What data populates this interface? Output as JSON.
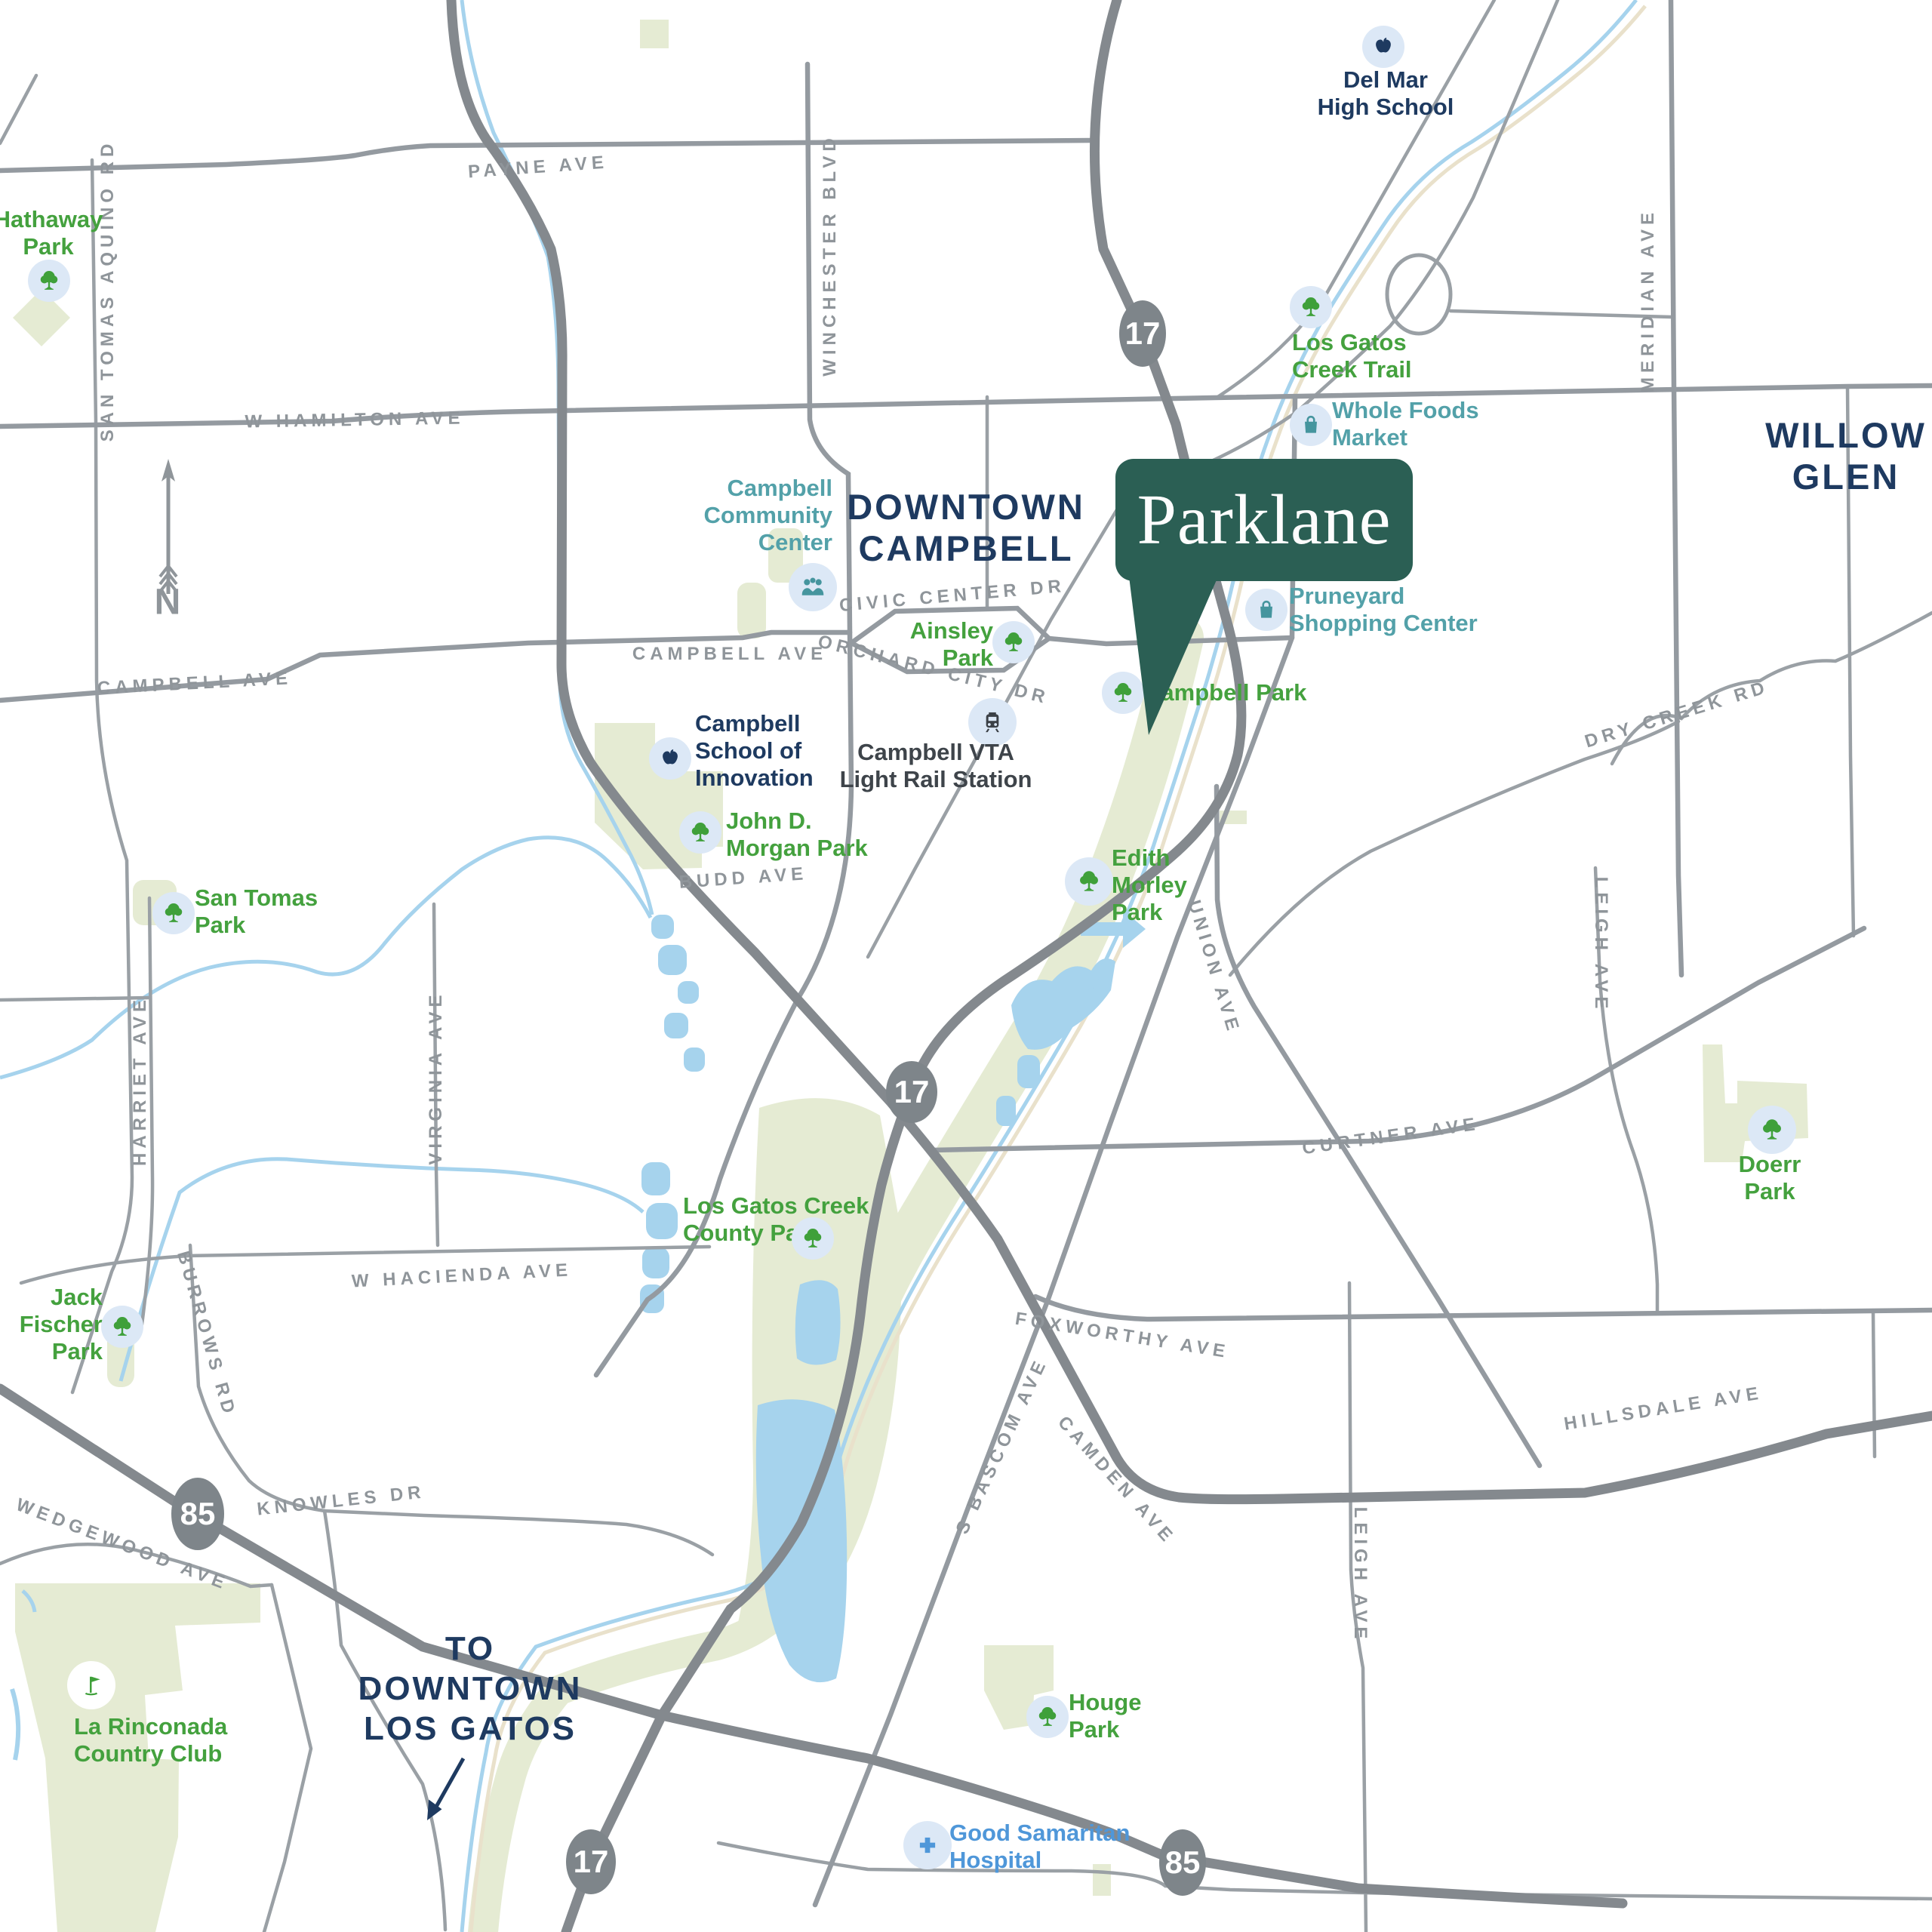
{
  "brand": {
    "name": "Parklane"
  },
  "compass": {
    "label": "N"
  },
  "areas": {
    "downtown_campbell": "DOWNTOWN\nCAMPBELL",
    "willow_glen": "WILLOW\nGLEN",
    "to_downtown_los_gatos": "TO\nDOWNTOWN\nLOS GATOS"
  },
  "shields": {
    "hwy_17": "17",
    "hwy_85": "85"
  },
  "roads": {
    "payne": "PAYNE AVE",
    "san_tomas_aquino": "SAN TOMAS AQUINO RD",
    "w_hamilton": "W HAMILTON AVE",
    "winchester": "WINCHESTER BLVD",
    "campbell_w": "CAMPBELL AVE",
    "campbell_e": "CAMPBELL AVE",
    "civic_center": "CIVIC CENTER DR",
    "orchard_city": "ORCHARD CITY DR",
    "budd": "BUDD AVE",
    "harriet": "HARRIET AVE",
    "virginia": "VIRGINIA AVE",
    "union": "UNION AVE",
    "curtner": "CURTNER AVE",
    "dry_creek": "DRY CREEK RD",
    "meridian": "MERIDIAN AVE",
    "leigh_n": "LEIGH AVE",
    "leigh_s": "LEIGH AVE",
    "w_hacienda": "W HACIENDA AVE",
    "burrows": "BURROWS RD",
    "knowles": "KNOWLES DR",
    "wedgewood": "WEDGEWOOD AVE",
    "foxworthy": "FOXWORTHY AVE",
    "s_bascom": "S BASCOM AVE",
    "camden": "CAMDEN AVE",
    "hillsdale": "HILLSDALE AVE"
  },
  "pois": {
    "hathaway_park": "Hathaway\nPark",
    "del_mar_high_school": "Del Mar\nHigh School",
    "los_gatos_creek_trail": "Los Gatos\nCreek Trail",
    "whole_foods_market": "Whole Foods\nMarket",
    "pruneyard_shopping_center": "Pruneyard\nShopping Center",
    "campbell_community_center": "Campbell\nCommunity\nCenter",
    "ainsley_park": "Ainsley\nPark",
    "campbell_park": "Campbell Park",
    "campbell_vta_light_rail_station": "Campbell VTA\nLight Rail Station",
    "campbell_school_of_innovation": "Campbell\nSchool of\nInnovation",
    "john_d_morgan_park": "John D.\nMorgan Park",
    "san_tomas_park": "San Tomas\nPark",
    "edith_morley_park": "Edith\nMorley\nPark",
    "los_gatos_creek_county_park": "Los Gatos Creek\nCounty Park",
    "jack_fischer_park": "Jack\nFischer\nPark",
    "doerr_park": "Doerr\nPark",
    "houge_park": "Houge\nPark",
    "la_rinconada_country_club": "La Rinconada\nCountry Club",
    "good_samaritan_hospital": "Good Samaritan\nHospital"
  },
  "colors": {
    "brand_flag": "#2b5f54",
    "park_green": "#44a13e",
    "school_navy": "#1e3a60",
    "shopping_teal": "#53a1a9",
    "hospital_blue": "#4f97d9",
    "transit_dark": "#3e444a",
    "road_label_gray": "#8f959a",
    "highway_badge_gray": "#7e858a",
    "park_fill": "#e5ebd3",
    "water_fill": "#a6d3ed"
  },
  "icons": {
    "park": "tree-icon",
    "golf": "golf-flag-icon",
    "school": "apple-icon",
    "shopping": "shopping-bag-icon",
    "community": "people-icon",
    "transit": "light-rail-icon",
    "hospital": "medical-cross-icon",
    "compass": "north-arrow-icon",
    "direction": "down-left-arrow-icon"
  }
}
